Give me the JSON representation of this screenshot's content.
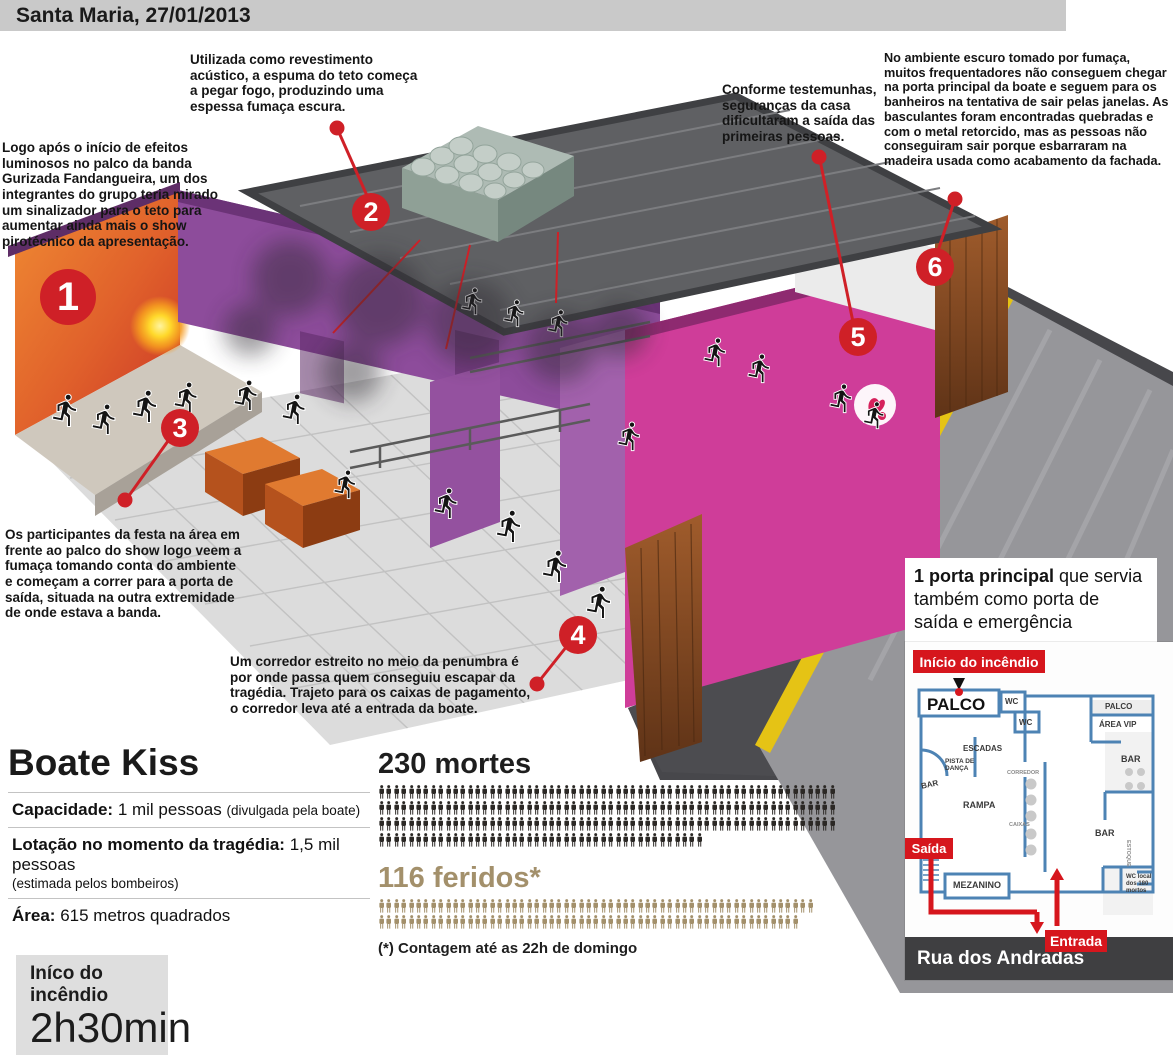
{
  "header": {
    "title": "Santa Maria, 27/01/2013"
  },
  "callouts": [
    {
      "number": "1",
      "text": "Logo após o início de efeitos luminosos no palco da banda Gurizada Fandangueira, um dos integrantes do grupo teria mirado um sinalizador para o teto para aumentar ainda mais o show pirotécnico da apresentação."
    },
    {
      "number": "2",
      "text": "Utilizada como revestimento acústico, a espuma do teto começa a pegar fogo, produzindo uma espessa fumaça escura."
    },
    {
      "number": "3",
      "text": "Os participantes da festa na área em frente ao palco do show logo veem a fumaça tomando conta do ambiente e começam a correr para a porta de saída, situada na outra extremidade de onde estava a banda."
    },
    {
      "number": "4",
      "text": "Um corredor estreito no meio da penumbra é por onde passa quem conseguiu escapar da tragédia. Trajeto para os caixas de pagamento, o corredor leva até a entrada da boate."
    },
    {
      "number": "5",
      "text": "Conforme testemunhas, seguranças da casa dificultaram a saída das primeiras pessoas."
    },
    {
      "number": "6",
      "text": "No ambiente escuro tomado por fumaça, muitos frequentadores não conseguem chegar na porta principal da boate e seguem para os banheiros na tentativa de sair pelas janelas. As basculantes foram encontradas quebradas e com o metal retorcido, mas as pessoas não conseguiram sair porque esbarraram na madeira usada como acabamento da fachada."
    }
  ],
  "info_panel": {
    "title": "Boate Kiss",
    "rows": [
      {
        "label": "Capacidade:",
        "value": " 1 mil pessoas ",
        "note": "(divulgada pela boate)",
        "note_block": false
      },
      {
        "label": "Lotação no momento da tragédia:",
        "value": " 1,5 mil pessoas",
        "note": "(estimada pelos bombeiros)",
        "note_block": true
      },
      {
        "label": "Área:",
        "value": " 615 metros quadrados",
        "note": "",
        "note_block": false
      }
    ],
    "fire_start": {
      "label": "Iníco do incêndio",
      "time": "2h30min"
    }
  },
  "casualties": {
    "deaths": {
      "title": "230 mortes",
      "count": 230,
      "rows": [
        62,
        62,
        62,
        44
      ],
      "color": "#2b2825"
    },
    "injured": {
      "title": "116 feridos*",
      "count": 116,
      "rows": [
        59,
        57
      ],
      "color": "#a3906b"
    },
    "footnote": "(*) Contagem até as 22h de domingo"
  },
  "door_note": {
    "bold": "1 porta principal",
    "rest": " que servia também como porta de saída e emergência"
  },
  "floor_plan": {
    "fire_origin_label": "Início do incêndio",
    "exit_label": "Saída",
    "entrance_label": "Entrada",
    "street": "Rua dos Andradas",
    "rooms": {
      "palco": "PALCO",
      "wc1": "WC",
      "palco2": "PALCO",
      "area_vip": "ÁREA VIP",
      "wc2": "WC",
      "escadas": "ESCADAS",
      "pista": "PISTA DE DANÇA",
      "bar_left": "BAR",
      "rampa": "RAMPA",
      "corredor": "CORREDOR",
      "caixas": "CAIXAS",
      "bar_right": "BAR",
      "bar_mid": "BAR",
      "estoque": "ESTOQUE",
      "mezanino": "MEZANINO",
      "wc3": "WC local dos 180 mortos"
    }
  },
  "colors": {
    "accent_red": "#cf2027",
    "injured_tan": "#a3906b",
    "plan_blue": "#4d83b4",
    "facade_magenta": "#cf3d99",
    "wall_purple": "#8d4c9b",
    "street_dark": "#47474b",
    "curb_yellow": "#e5c315"
  }
}
